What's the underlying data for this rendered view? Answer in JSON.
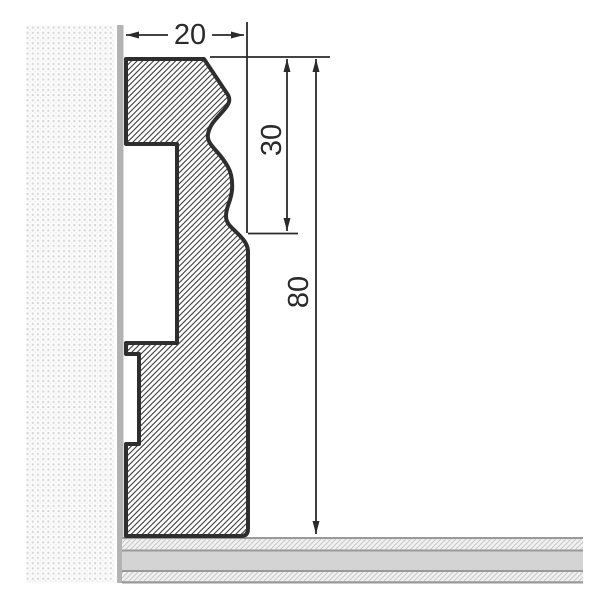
{
  "diagram": {
    "type": "technical-cross-section",
    "subject": "skirting-board-profile-on-wall-and-floor",
    "dimensions": {
      "width": {
        "label": "20",
        "orientation": "horizontal"
      },
      "upper_height": {
        "label": "30",
        "orientation": "vertical"
      },
      "total_height": {
        "label": "80",
        "orientation": "vertical"
      }
    },
    "colors": {
      "outline": "#2e2e2e",
      "hatch_line": "#3d3d3d",
      "dimension": "#2a2a2a",
      "wall_dot": "#d2d2d2",
      "wall_background": "#fbfbfb",
      "wall_surface_strip": "#b3b3b3",
      "floor_solid": "#d4d4d4",
      "floor_divider": "#9a9a9a",
      "floor_hatch_bg": "#f2f2f2",
      "floor_hatch_line": "#c6c6c6",
      "background": "#ffffff"
    }
  }
}
